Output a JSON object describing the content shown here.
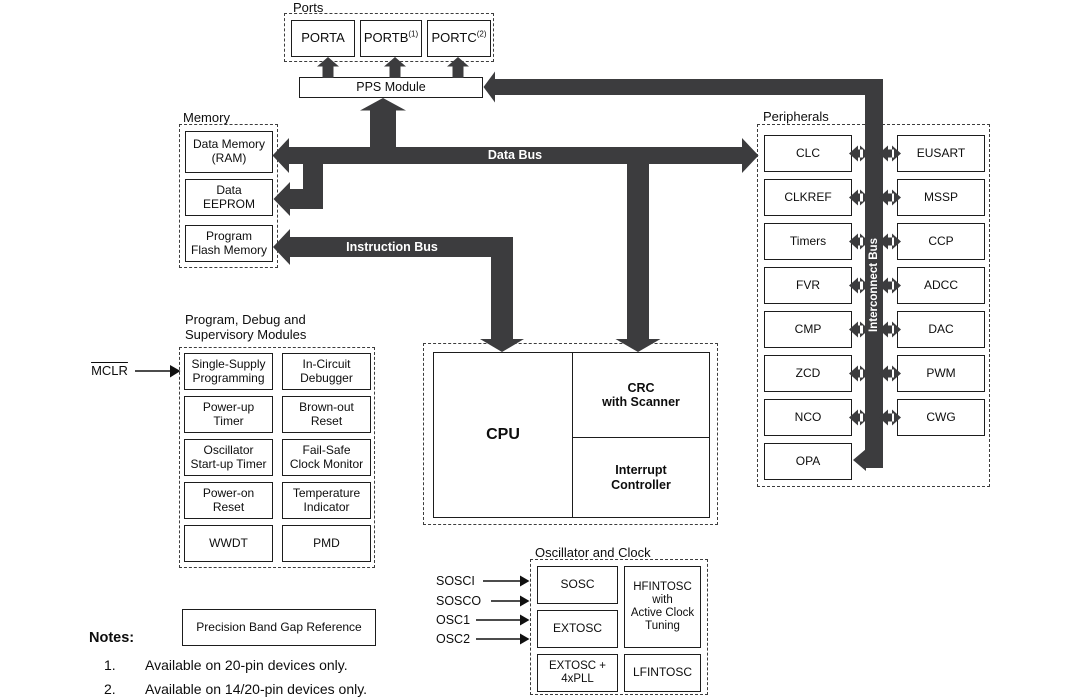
{
  "colors": {
    "bus": "#3c3c3e",
    "line": "#111111",
    "background": "#ffffff"
  },
  "ports": {
    "group_label": "Ports",
    "items": [
      {
        "label": "PORTA",
        "sup": ""
      },
      {
        "label": "PORTB",
        "sup": "(1)"
      },
      {
        "label": "PORTC",
        "sup": "(2)"
      }
    ]
  },
  "pps": {
    "label": "PPS Module"
  },
  "memory": {
    "group_label": "Memory",
    "items": [
      {
        "line1": "Data Memory",
        "line2": "(RAM)"
      },
      {
        "line1": "Data",
        "line2": "EEPROM"
      },
      {
        "line1": "Program",
        "line2": "Flash Memory"
      }
    ]
  },
  "buses": {
    "data_bus_label": "Data Bus",
    "instruction_bus_label": "Instruction Bus",
    "interconnect_bus_label": "Interconnect Bus"
  },
  "mclr": {
    "label": "MCLR"
  },
  "debug_modules": {
    "group_label_line1": "Program, Debug and",
    "group_label_line2": "Supervisory Modules",
    "items": [
      {
        "line1": "Single-Supply",
        "line2": "Programming"
      },
      {
        "line1": "In-Circuit",
        "line2": "Debugger"
      },
      {
        "line1": "Power-up",
        "line2": "Timer"
      },
      {
        "line1": "Brown-out",
        "line2": "Reset"
      },
      {
        "line1": "Oscillator",
        "line2": "Start-up Timer"
      },
      {
        "line1": "Fail-Safe",
        "line2": "Clock Monitor"
      },
      {
        "line1": "Power-on",
        "line2": "Reset"
      },
      {
        "line1": "Temperature",
        "line2": "Indicator"
      },
      {
        "line1": "WWDT",
        "line2": ""
      },
      {
        "line1": "PMD",
        "line2": ""
      }
    ]
  },
  "cpu": {
    "label": "CPU",
    "crc": {
      "line1": "CRC",
      "line2": "with Scanner"
    },
    "interrupt": {
      "line1": "Interrupt",
      "line2": "Controller"
    }
  },
  "peripherals": {
    "group_label": "Peripherals",
    "left_column": [
      "CLC",
      "CLKREF",
      "Timers",
      "FVR",
      "CMP",
      "ZCD",
      "NCO",
      "OPA"
    ],
    "right_column": [
      "EUSART",
      "MSSP",
      "CCP",
      "ADCC",
      "DAC",
      "PWM",
      "CWG"
    ]
  },
  "oscillator": {
    "group_label": "Oscillator and Clock",
    "pins": [
      "SOSCI",
      "SOSCO",
      "OSC1",
      "OSC2"
    ],
    "sosc": "SOSC",
    "extosc": "EXTOSC",
    "extosc_pll": {
      "line1": "EXTOSC +",
      "line2": "4xPLL"
    },
    "hfintosc": {
      "line1": "HFINTOSC",
      "line2": "with",
      "line3": "Active Clock",
      "line4": "Tuning"
    },
    "lfintosc": "LFINTOSC"
  },
  "bandgap": {
    "label": "Precision Band Gap Reference"
  },
  "notes": {
    "heading": "Notes:",
    "items": [
      {
        "number": "1.",
        "text": "Available on 20-pin devices only."
      },
      {
        "number": "2.",
        "text": "Available on 14/20-pin devices only."
      }
    ]
  }
}
